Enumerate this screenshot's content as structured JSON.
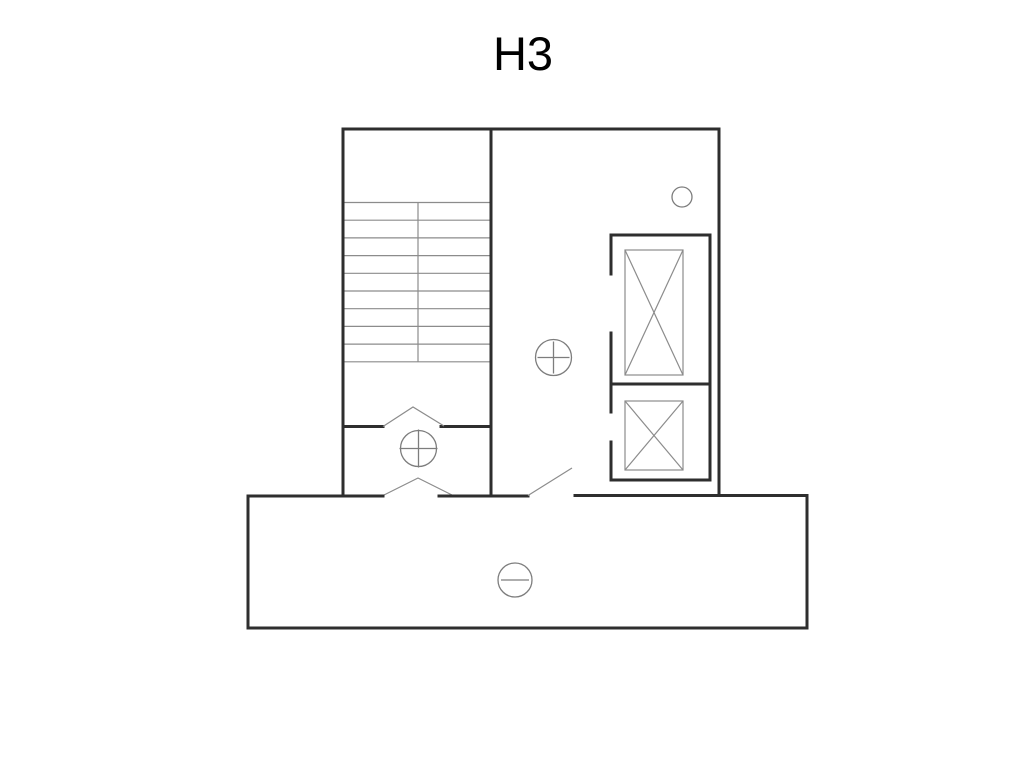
{
  "title": "H3",
  "colors": {
    "background": "#ffffff",
    "wall": "#2e2e2e",
    "thin": "#8c8c8c",
    "symbol": "#7d7d7d",
    "text": "#000000"
  },
  "plan": {
    "stair_tread_count": 10,
    "elevator_count": 2,
    "markers": {
      "circle_plus_count": 2,
      "circle_minus_count": 1,
      "small_circle_count": 1
    }
  }
}
